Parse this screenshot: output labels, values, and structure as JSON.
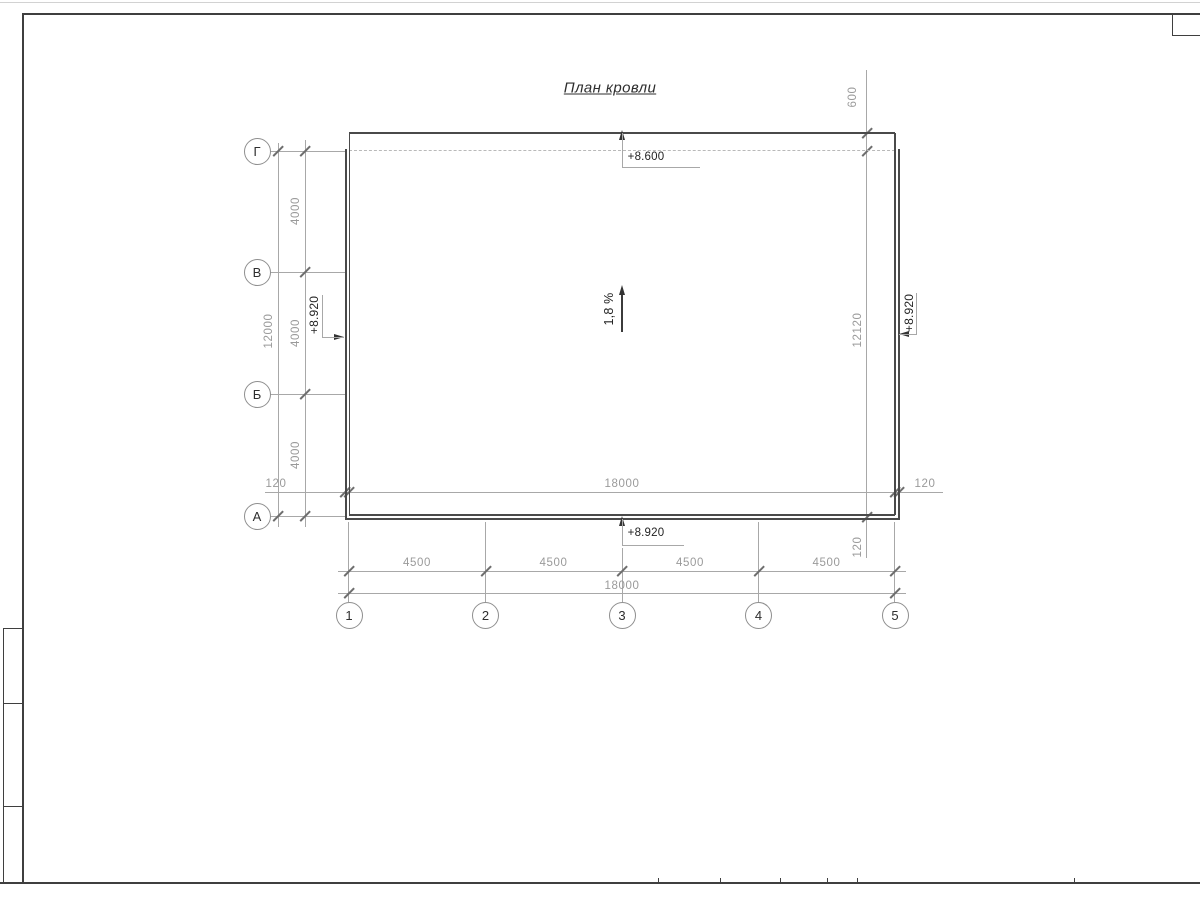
{
  "title": "План кровли",
  "axes": {
    "rows": [
      "Г",
      "В",
      "Б",
      "А"
    ],
    "cols": [
      "1",
      "2",
      "3",
      "4",
      "5"
    ]
  },
  "dims": {
    "left_bays": [
      "4000",
      "4000",
      "4000"
    ],
    "left_total": "12000",
    "bottom_bays": [
      "4500",
      "4500",
      "4500",
      "4500"
    ],
    "bottom_total": "18000",
    "width_inner": "18000",
    "eave_left": "120",
    "eave_right": "120",
    "eave_bottom": "120",
    "eave_top": "600",
    "height_right": "12120"
  },
  "elevations": {
    "roof_top": "+8.600",
    "eave_bottom": "+8.920",
    "eave_left": "+8.920",
    "eave_right": "+8.920"
  },
  "slope_label": "1,8 %",
  "colors": {
    "building_line": "#4a4a4a",
    "dimension_line": "#a8a8a8",
    "dimension_text": "#9a9a9a",
    "annotation_text": "#232323"
  }
}
